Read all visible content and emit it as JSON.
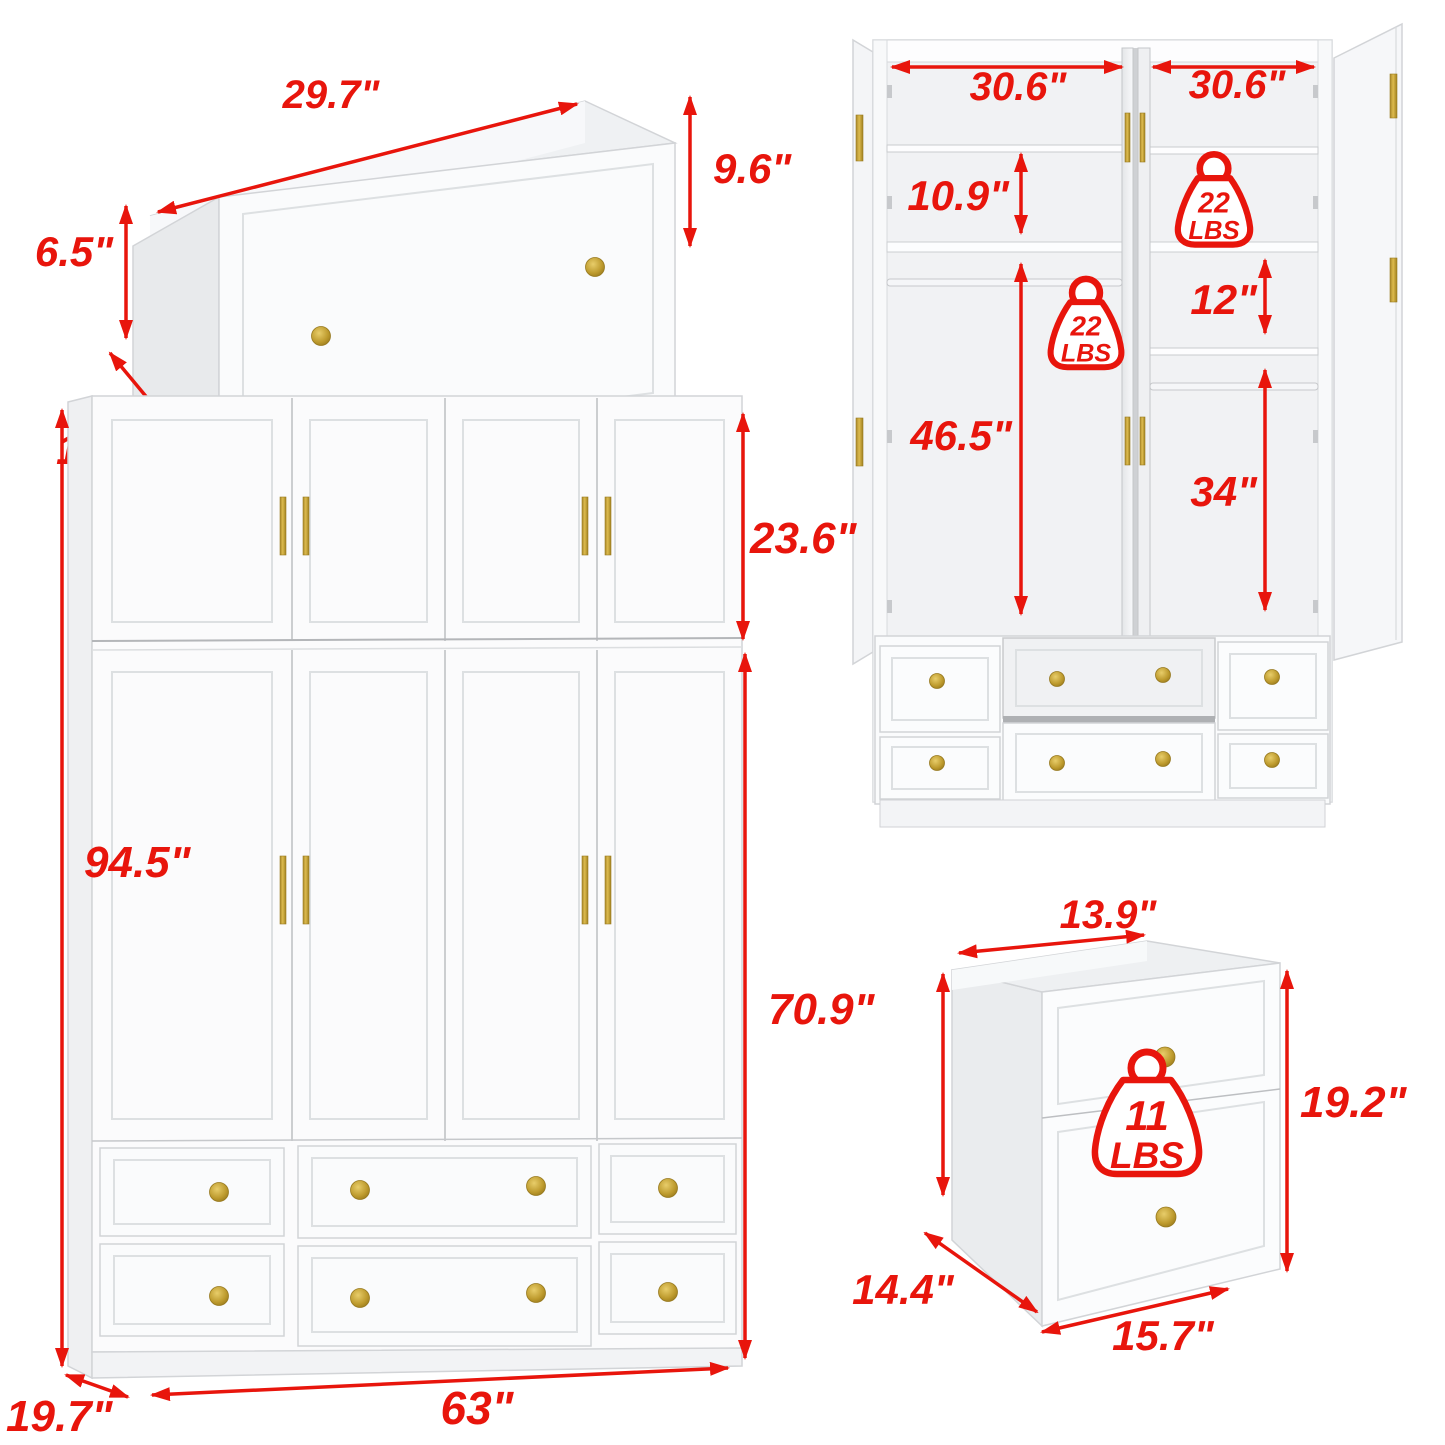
{
  "colors": {
    "dimension_red": "#e8150c",
    "handle_gold": "#c49a2e",
    "furniture_white": "#fbfcfd"
  },
  "views": {
    "drawer_open_top": {
      "labels": {
        "top_width": "29.7\"",
        "back_height": "6.5\"",
        "depth": "14.4\"",
        "front_width": "31.5\"",
        "front_height": "9.6\""
      }
    },
    "wardrobe_interior": {
      "labels": {
        "left_section_width": "30.6\"",
        "right_section_width": "30.6\"",
        "top_shelf_height": "10.9\"",
        "right_shelf_gap": "12\"",
        "left_hanging_height": "46.5\"",
        "right_hanging_height": "34\""
      },
      "weight_top": {
        "icon": "weight-icon",
        "value": "22",
        "unit": "LBS"
      },
      "weight_left": {
        "icon": "weight-icon",
        "value": "22",
        "unit": "LBS"
      }
    },
    "wardrobe_front": {
      "labels": {
        "top_cabinet_height": "23.6\"",
        "total_height": "94.5\"",
        "lower_height": "70.9\"",
        "width": "63\"",
        "depth": "19.7\""
      }
    },
    "drawer_small": {
      "labels": {
        "top_width": "13.9\"",
        "front_height": "19.2\"",
        "depth": "14.4\"",
        "front_width": "15.7\""
      },
      "weight": {
        "icon": "weight-icon",
        "value": "11",
        "unit": "LBS"
      }
    }
  }
}
